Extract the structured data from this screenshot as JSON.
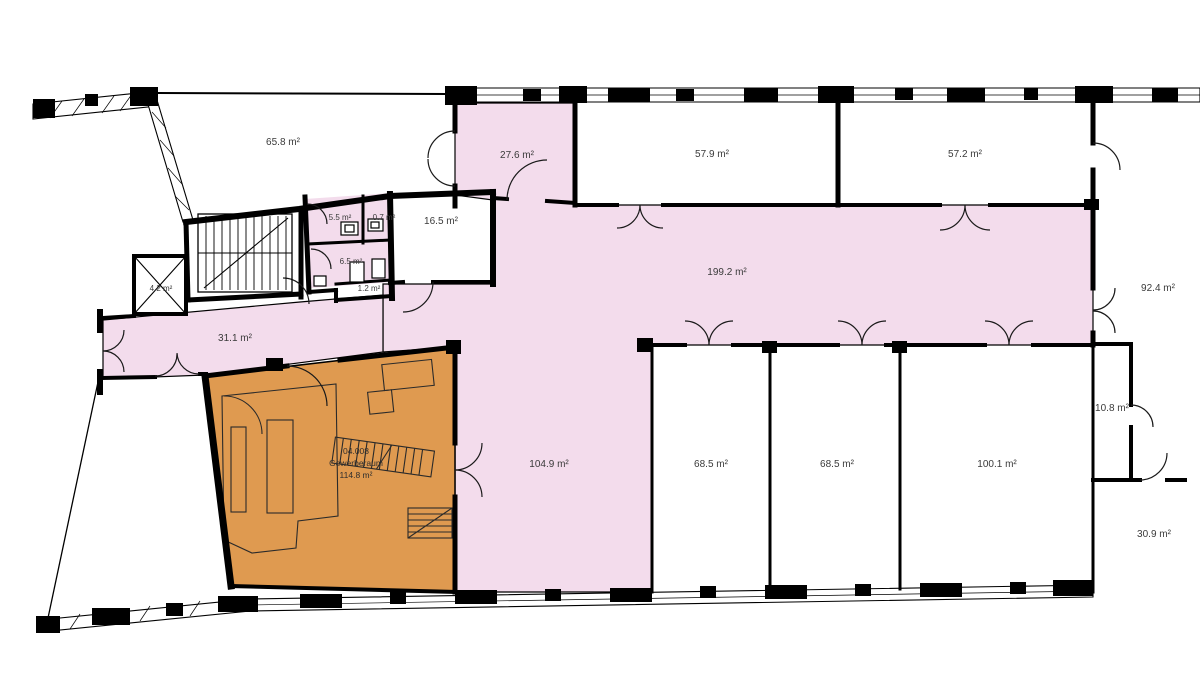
{
  "plan": {
    "labels": {
      "r65": "65.8 m²",
      "r27": "27.6 m²",
      "r57a": "57.9 m²",
      "r57b": "57.2 m²",
      "r199": "199.2 m²",
      "r92": "92.4 m²",
      "r16": "16.5 m²",
      "r55": "5.5 m²",
      "r07": "0.7 m²",
      "r6": "6.5 m²",
      "r12": "1.2 m²",
      "r42": "4.2 m²",
      "r31": "31.1 m²",
      "r104": "104.9 m²",
      "r68a": "68.5 m²",
      "r68b": "68.5 m²",
      "r100": "100.1 m²",
      "r10": "10.8 m²",
      "r30": "30.9 m²"
    },
    "unit": {
      "code": "04.008",
      "name": "Gewerberaum",
      "area": "114.8 m²"
    },
    "colors": {
      "circulation": "#f3dcec",
      "unit_highlight": "#df9a50",
      "wall": "#000000",
      "label": "#3a3a3a",
      "background": "#ffffff"
    }
  }
}
